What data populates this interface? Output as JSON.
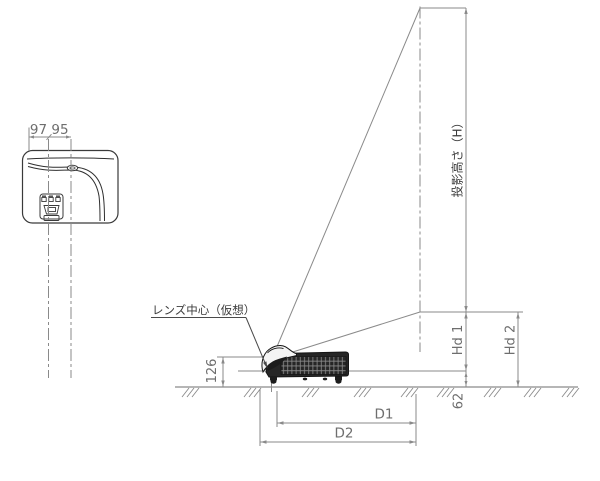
{
  "drawing_type": "projector installation dimension diagram",
  "top_view": {
    "dim_left": "97",
    "dim_right": "95"
  },
  "side_view": {
    "lens_center_label": "レンズ中心（仮想）",
    "lens_height_dim": "126",
    "floor_offset_dim": "62"
  },
  "screen_dims": {
    "projection_height_label": "投影高さ（H）",
    "hd1_label": "Hd 1",
    "hd2_label": "Hd 2"
  },
  "distance_dims": {
    "d1_label": "D1",
    "d2_label": "D2"
  },
  "colors": {
    "background": "#ffffff",
    "line_gray": "#8a8a8a",
    "dim_text_gray": "#6e6e6e",
    "label_dark": "#3c3c3c",
    "projector_dark": "#262626"
  }
}
